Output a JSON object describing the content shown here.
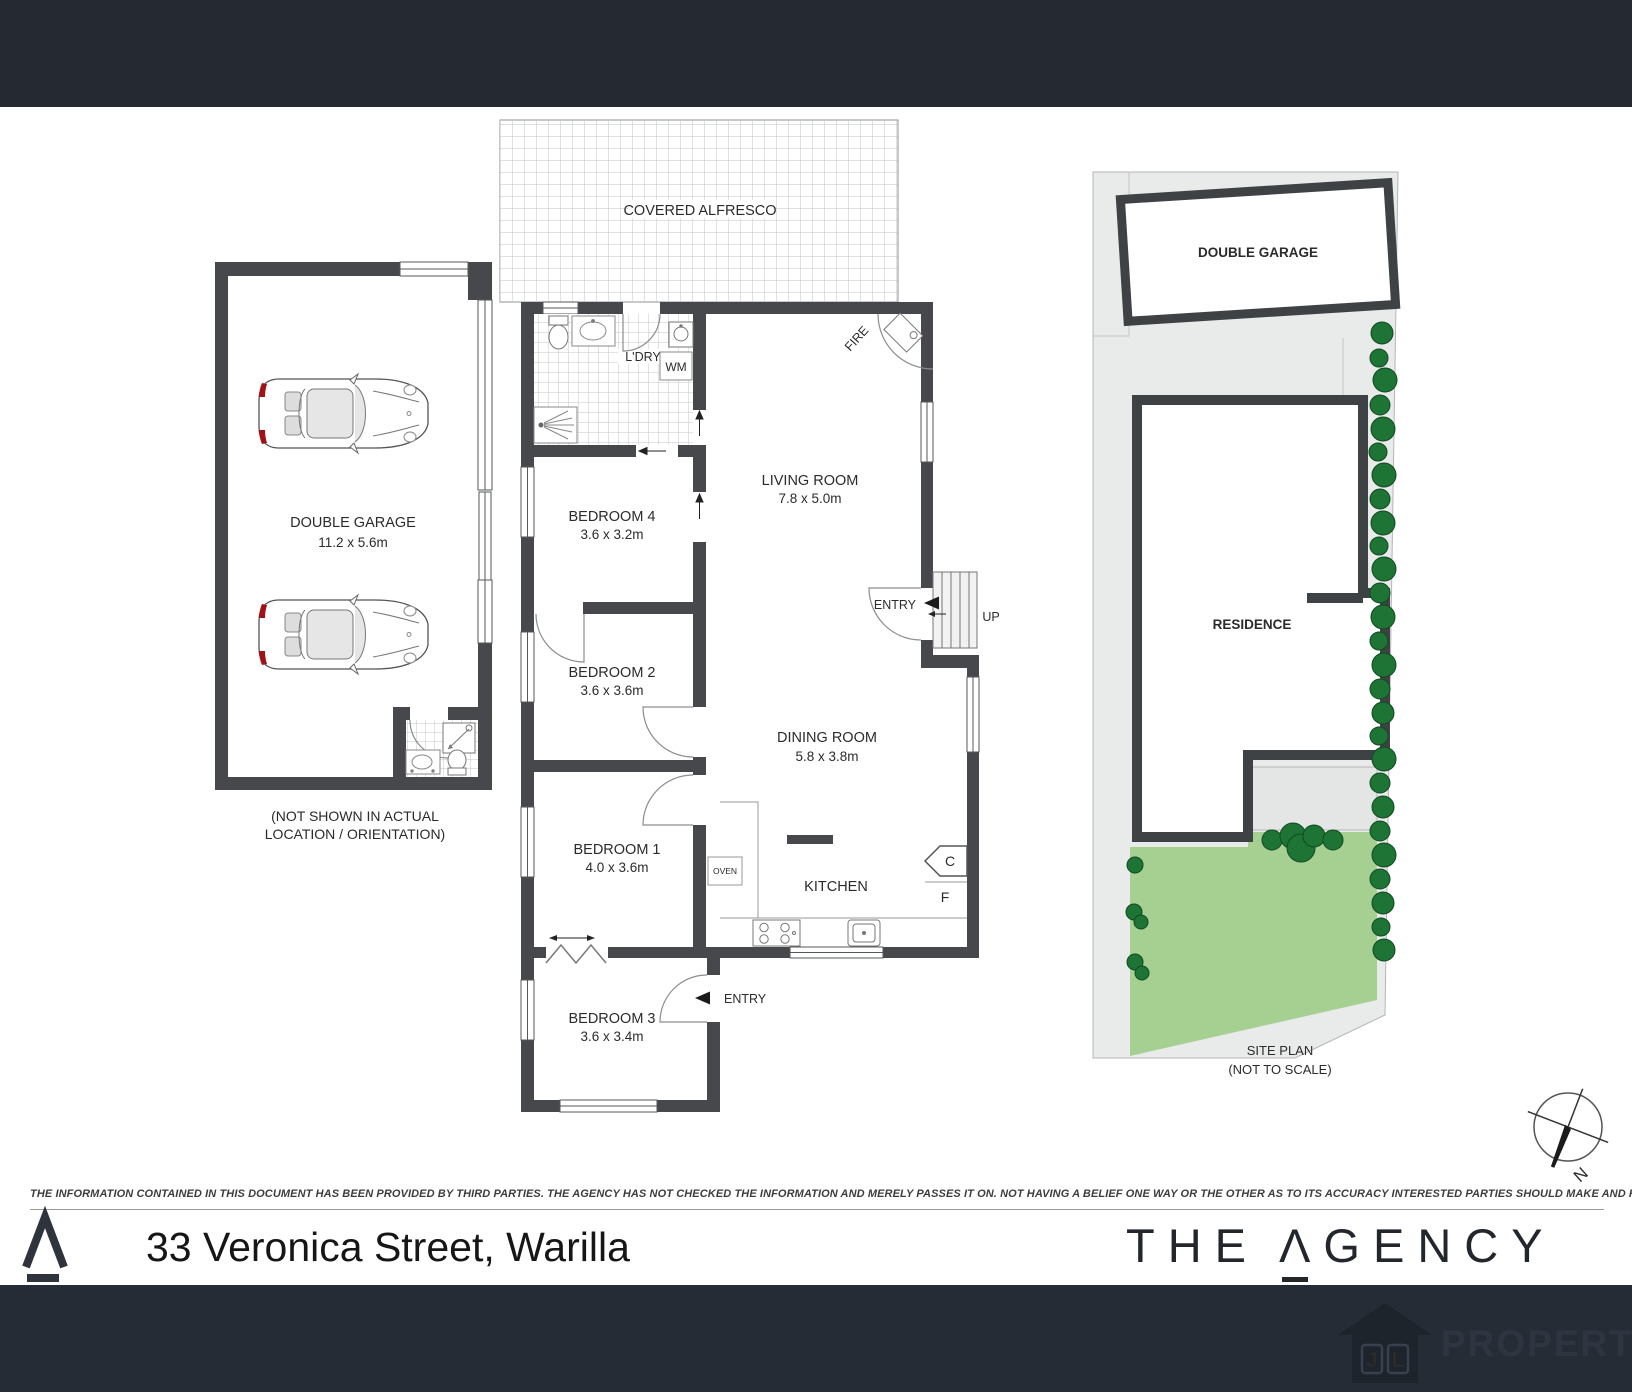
{
  "floorplan": {
    "alfresco_label": "COVERED ALFRESCO",
    "laundry_label": "L'DRY",
    "wm_label": "WM",
    "living_name": "LIVING ROOM",
    "living_dims": "7.8 x 5.0m",
    "fire_label": "FIRE",
    "entry_top_label": "ENTRY",
    "up_label": "UP",
    "bed4_name": "BEDROOM 4",
    "bed4_dims": "3.6 x 3.2m",
    "bed2_name": "BEDROOM 2",
    "bed2_dims": "3.6 x 3.6m",
    "bed1_name": "BEDROOM 1",
    "bed1_dims": "4.0 x 3.6m",
    "bed3_name": "BEDROOM 3",
    "bed3_dims": "3.6 x 3.4m",
    "dining_name": "DINING ROOM",
    "dining_dims": "5.8 x 3.8m",
    "kitchen_label": "KITCHEN",
    "oven_label": "OVEN",
    "cupboard_label": "C",
    "fridge_label": "F",
    "entry_bottom_label": "ENTRY"
  },
  "garage": {
    "name": "DOUBLE GARAGE",
    "dims": "11.2 x 5.6m",
    "note1": "(NOT SHOWN IN ACTUAL",
    "note2": "LOCATION / ORIENTATION)"
  },
  "siteplan": {
    "garage_label": "DOUBLE GARAGE",
    "residence_label": "RESIDENCE",
    "caption1": "SITE PLAN",
    "caption2": "(NOT TO SCALE)",
    "north_label": "N"
  },
  "disclaimer": "THE INFORMATION CONTAINED IN THIS DOCUMENT HAS BEEN PROVIDED BY THIRD PARTIES. THE AGENCY HAS NOT CHECKED THE INFORMATION AND MERELY PASSES IT ON. NOT HAVING A BELIEF ONE WAY OR  THE OTHER AS TO ITS ACCURACY   INTERESTED PARTIES SHOULD MAKE AND RELY UPON THEIR OWN ENQUIRIES.",
  "footer": {
    "address": "33 Veronica Street, Warilla",
    "brand_part1": "THE",
    "brand_a": "Λ",
    "brand_part2": "GENCY",
    "watermark_jl_j": "J",
    "watermark_jl_l": "L",
    "watermark_property": "PROPERTY"
  },
  "colors": {
    "wall": "#46484b",
    "header": "#242932",
    "footer": "#262c36",
    "lawn": "#a6cf92",
    "tree": "#1e7434"
  }
}
